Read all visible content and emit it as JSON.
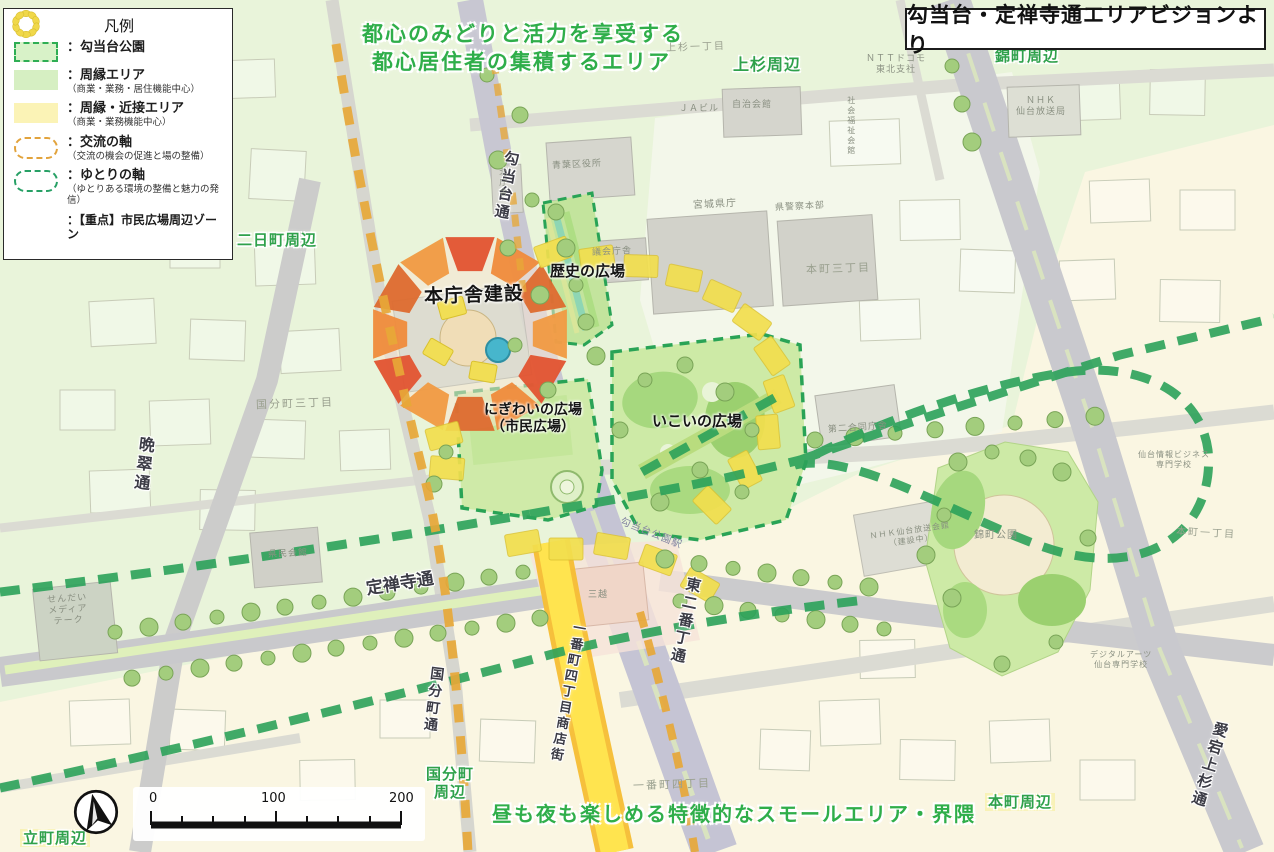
{
  "title_box": {
    "text": "勾当台・定禅寺通エリアビジョンより"
  },
  "legend": {
    "title": "凡例",
    "items": [
      {
        "label": "：勾当台公園",
        "sub": ""
      },
      {
        "label": "：周縁エリア",
        "sub": "（商業・業務・居住機能中心）"
      },
      {
        "label": "：周縁・近接エリア",
        "sub": "（商業・業務機能中心）"
      },
      {
        "label": "：交流の軸",
        "sub": "（交流の機会の促進と場の整備）"
      },
      {
        "label": "：ゆとりの軸",
        "sub": "（ゆとりある環境の整備と魅力の発信）"
      },
      {
        "label": "：【重点】市民広場周辺ゾーン",
        "sub": ""
      }
    ]
  },
  "annotations": {
    "top_line1": "都心のみどりと活力を享受する",
    "top_line2": "都心居住者の集積するエリア",
    "bottom": "昼も夜も楽しめる特徴的なスモールエリア・界隈"
  },
  "districts": {
    "kamisugi": "上杉周辺",
    "nishikicho": "錦町周辺",
    "futsukamachi": "二日町周辺",
    "kokubuncho": "国分町\n周辺",
    "tatemachi": "立町周辺",
    "honmachi": "本町周辺"
  },
  "features": {
    "honchosha": "本庁舎建設",
    "rekishi": "歴史の広場",
    "nigiwai": "にぎわいの広場\n（市民広場）",
    "ikoi": "いこいの広場"
  },
  "roads": {
    "kotodai": "勾当台通",
    "bansui": "晩翠通",
    "jozenji": "定禅寺通",
    "kokubuncho_dori": "国分町通",
    "ichibancho_shoutengai": "一番町四丁目商店街",
    "higashi_nibancho": "東二番丁通",
    "atago_kamisugi": "愛宕上杉通"
  },
  "buildings": {
    "jichikaikan": "自治会館",
    "ja_building": "ＪＡビル",
    "ntt_docomo": "ＮＴＴドコモ\n東北支社",
    "nhk_housoukyoku": "ＮＨＫ\n仙台放送局",
    "aoba_kuyakusho": "青葉区役所",
    "miyagi_kencho": "宮城県庁",
    "keisatsu_honbu": "県警察本部",
    "gikai_chosha": "議会庁舎",
    "kita_chosha": "北庁舎",
    "honmachi_3": "本町三丁目",
    "kamisugi_1": "上杉一丁目",
    "kokubuncho_3": "国分町三丁目",
    "kenmin_kaikan": "県民会館",
    "mediatheque": "せんだい\nメディア\nテーク",
    "mitsukoshi": "三越",
    "ichibancho_4": "一番町四丁目",
    "kotodai_koen_eki": "勾当台公園駅",
    "daini_godo": "第二合同庁舎",
    "nishikicho_koen": "錦町公園",
    "nhk_kaikan": "ＮＨＫ仙台放送会館\n（建設中）",
    "honmachi_1": "本町一丁目",
    "johobusiness": "仙台情報ビジネス\n専門学校",
    "digitalarts": "デジタルアーツ\n仙台専門学校",
    "shakaifukushi": "社会福祉会館"
  },
  "scale_bar": {
    "start": "0",
    "mid": "100",
    "end": "200"
  },
  "colors": {
    "area_green": "#e9f4da",
    "area_cream": "#faf6e2",
    "park_green": "#cdeaa6",
    "axis_green": "#2ca25a",
    "axis_orange": "#e8a838",
    "zone_yellow": "#f2df4e",
    "construction_orange": "#e4572e",
    "street_yellow": "#ffe44f",
    "district_label_green": "#2fa14b"
  }
}
